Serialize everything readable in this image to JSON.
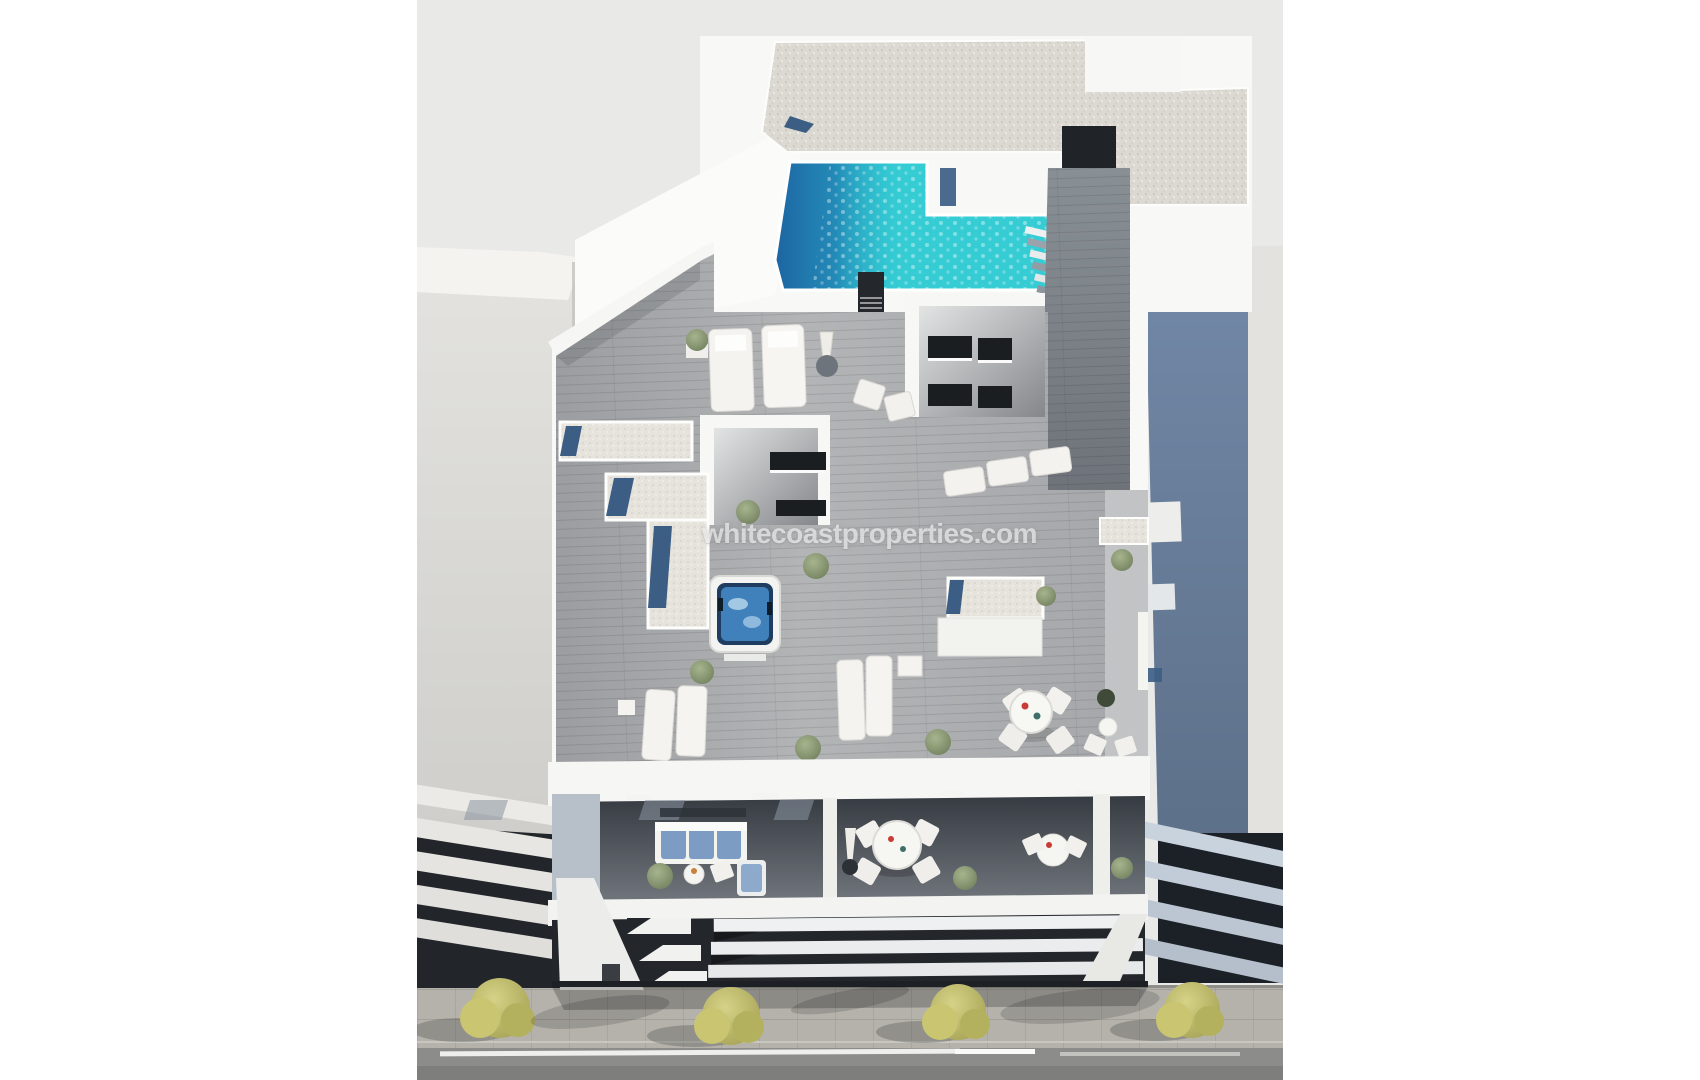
{
  "image": {
    "kind": "3D architectural render photo",
    "description": "Aerial 3D render of a modern white apartment building with a rooftop pool, sun terraces with loungers and hot tub, furnished balconies and a louvred street facade, flanked by neighbouring buildings on a tree-lined street",
    "watermark": "whitecoastproperties.com"
  },
  "colors": {
    "page_background": "#ffffff",
    "render_background": "#e9e9e8",
    "building_white": "#f8f8f6",
    "pool_turquoise": "#35ccd4",
    "pool_deep_blue": "#1c5f9f",
    "skylight_blue": "#3c5d84",
    "hot_tub_water": "#4181bb",
    "deck_gray": "#abadb0",
    "walkway_gray": "#7f848b",
    "gravel_beige": "#dcd9d2",
    "pebble_light": "#e6e3dc",
    "left_building_gray": "#dbdad6",
    "right_building_blue": "#7289a8",
    "louver_dark": "#23262b",
    "balcony_shadow_dark": "#41464e",
    "sofa_blue": "#7d9cc4",
    "plant_green": "#8da076",
    "tree_yellow_green": "#c9c571",
    "sidewalk_gray": "#b5b2ac",
    "road_gray": "#8c8c8a",
    "marking_white": "#eeeeec"
  }
}
